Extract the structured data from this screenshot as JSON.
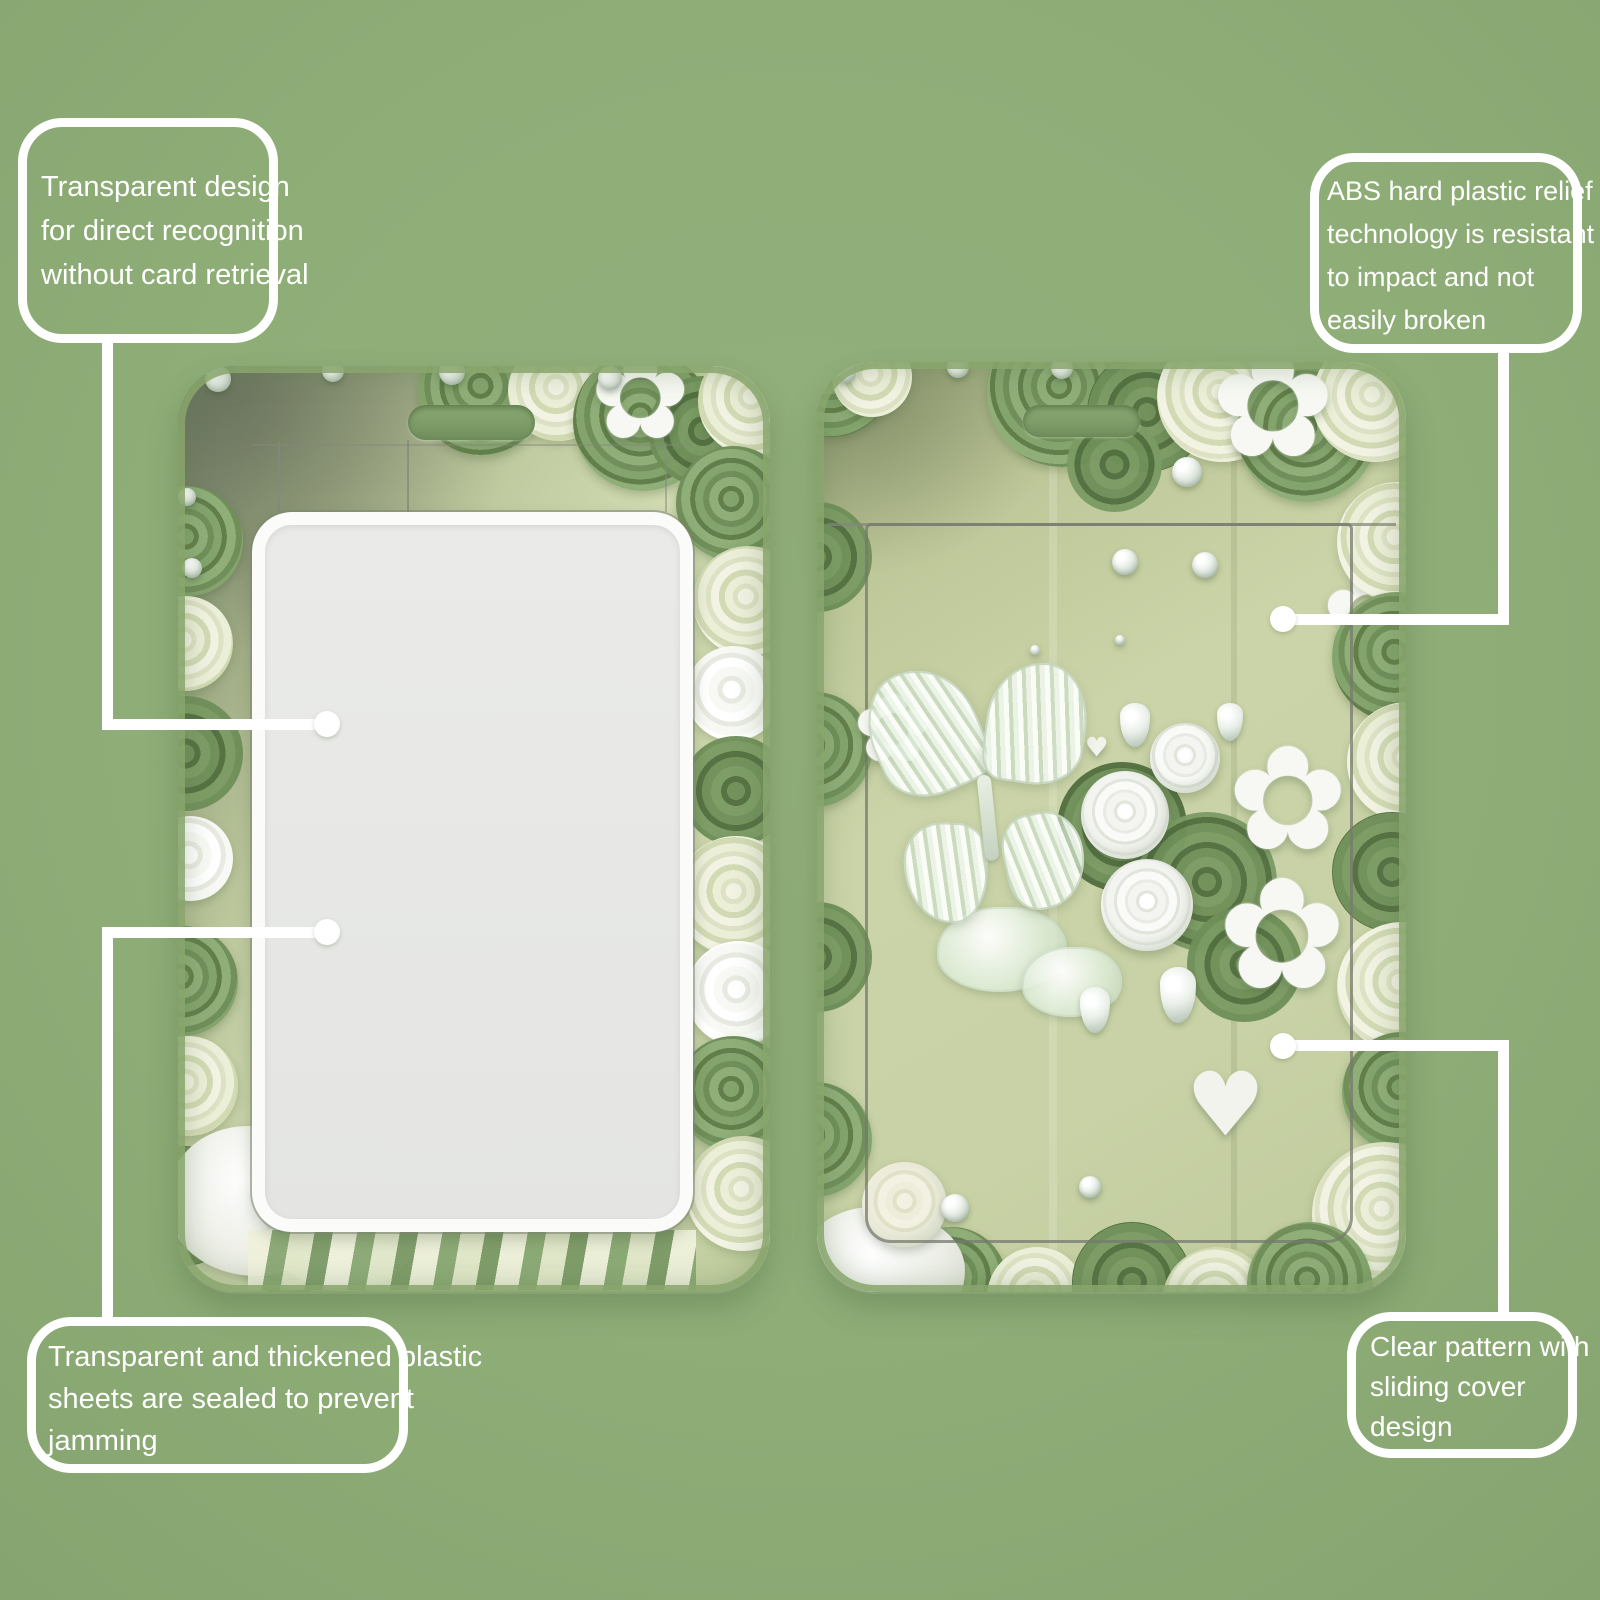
{
  "page": {
    "background_color": "#8ead77",
    "accent_color": "#ffffff",
    "seam_color": "#84887d",
    "card_interior_color": "#c8d2a6",
    "window_color": "#e7e8e6"
  },
  "icons": {
    "flower": "✿",
    "heart": "♥"
  },
  "callouts": {
    "top_left": {
      "lines": [
        "Transparent design",
        "for direct recognition",
        "without card retrieval"
      ]
    },
    "top_right": {
      "lines": [
        "ABS hard plastic relief",
        "technology is resistant",
        "to impact and not",
        "easily broken"
      ]
    },
    "bottom_left": {
      "lines": [
        "Transparent and thickened plastic",
        "sheets are sealed to prevent",
        "jamming"
      ]
    },
    "bottom_right": {
      "lines": [
        "Clear pattern with",
        "sliding cover",
        "design"
      ]
    }
  }
}
